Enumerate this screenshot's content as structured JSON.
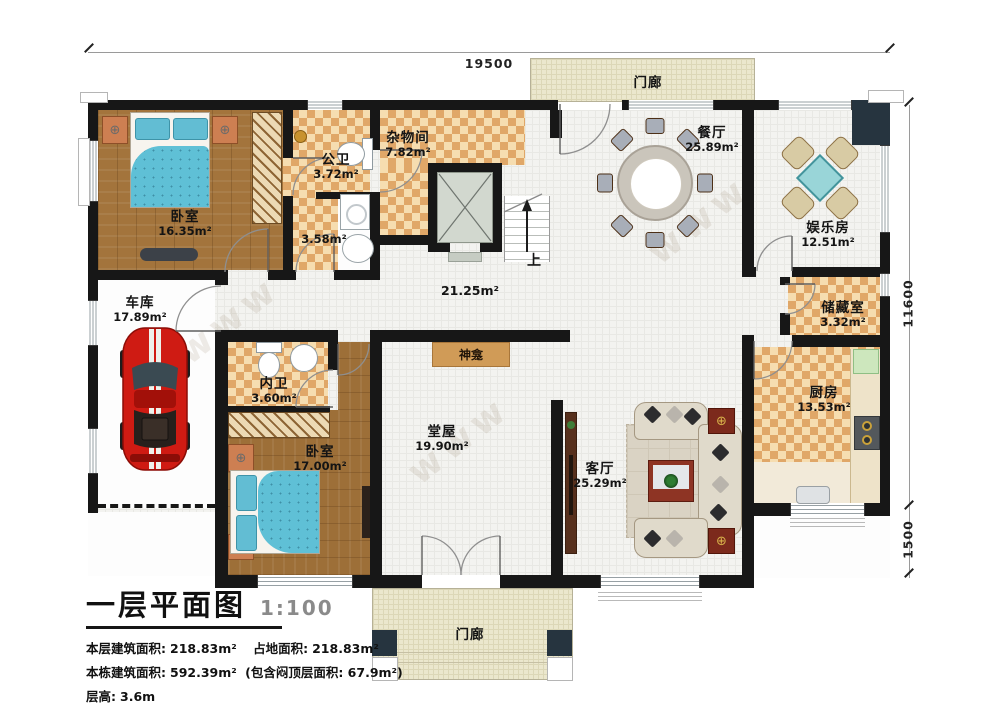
{
  "dimensions": {
    "width_top": "19500",
    "height_main": "11600",
    "height_porch": "1500"
  },
  "rooms": {
    "bedroom1": {
      "name": "卧室",
      "area": "16.35m²"
    },
    "public_bath": {
      "name": "公卫",
      "area": "3.72m²"
    },
    "bath_annex": {
      "area": "3.58m²"
    },
    "utility": {
      "name": "杂物间",
      "area": "7.82m²"
    },
    "dining": {
      "name": "餐厅",
      "area": "25.89m²"
    },
    "entertainment": {
      "name": "娱乐房",
      "area": "12.51m²"
    },
    "hall_center": {
      "area": "21.25m²"
    },
    "garage": {
      "name": "车库",
      "area": "17.89m²"
    },
    "storage": {
      "name": "储藏室",
      "area": "3.32m²"
    },
    "kitchen": {
      "name": "厨房",
      "area": "13.53m²"
    },
    "inner_bath": {
      "name": "内卫",
      "area": "3.60m²"
    },
    "bedroom2": {
      "name": "卧室",
      "area": "17.00m²"
    },
    "main_hall": {
      "name": "堂屋",
      "area": "19.90m²"
    },
    "living": {
      "name": "客厅",
      "area": "25.29m²"
    },
    "porch_top": {
      "name": "门廊"
    },
    "porch_bottom": {
      "name": "门廊"
    }
  },
  "annotations": {
    "shrine": "神龛",
    "stairs_up": "上",
    "watermark": "www"
  },
  "icons": {
    "knob": "⊕"
  },
  "title_block": {
    "title": "一层平面图",
    "scale": "1:100",
    "floor_area_label": "本层建筑面积:",
    "floor_area_value": "218.83m²",
    "land_area_label": "占地面积:",
    "land_area_value": "218.83m²",
    "total_area_label": "本栋建筑面积:",
    "total_area_value": "592.39m²",
    "total_area_note": "(包含闷顶层面积: 67.9m²)",
    "floor_height_label": "层高:",
    "floor_height_value": "3.6m"
  },
  "colors": {
    "wall": "#171717",
    "corner_column": "#26343f",
    "checker_dark": "#e0a768",
    "checker_light": "#f6ddb0",
    "wood": "#a3743c",
    "bed_teal": "#5fc0d6",
    "car_red": "#cf1b13",
    "porch": "#ebe7cd",
    "shrine_tan": "#d09b57"
  }
}
